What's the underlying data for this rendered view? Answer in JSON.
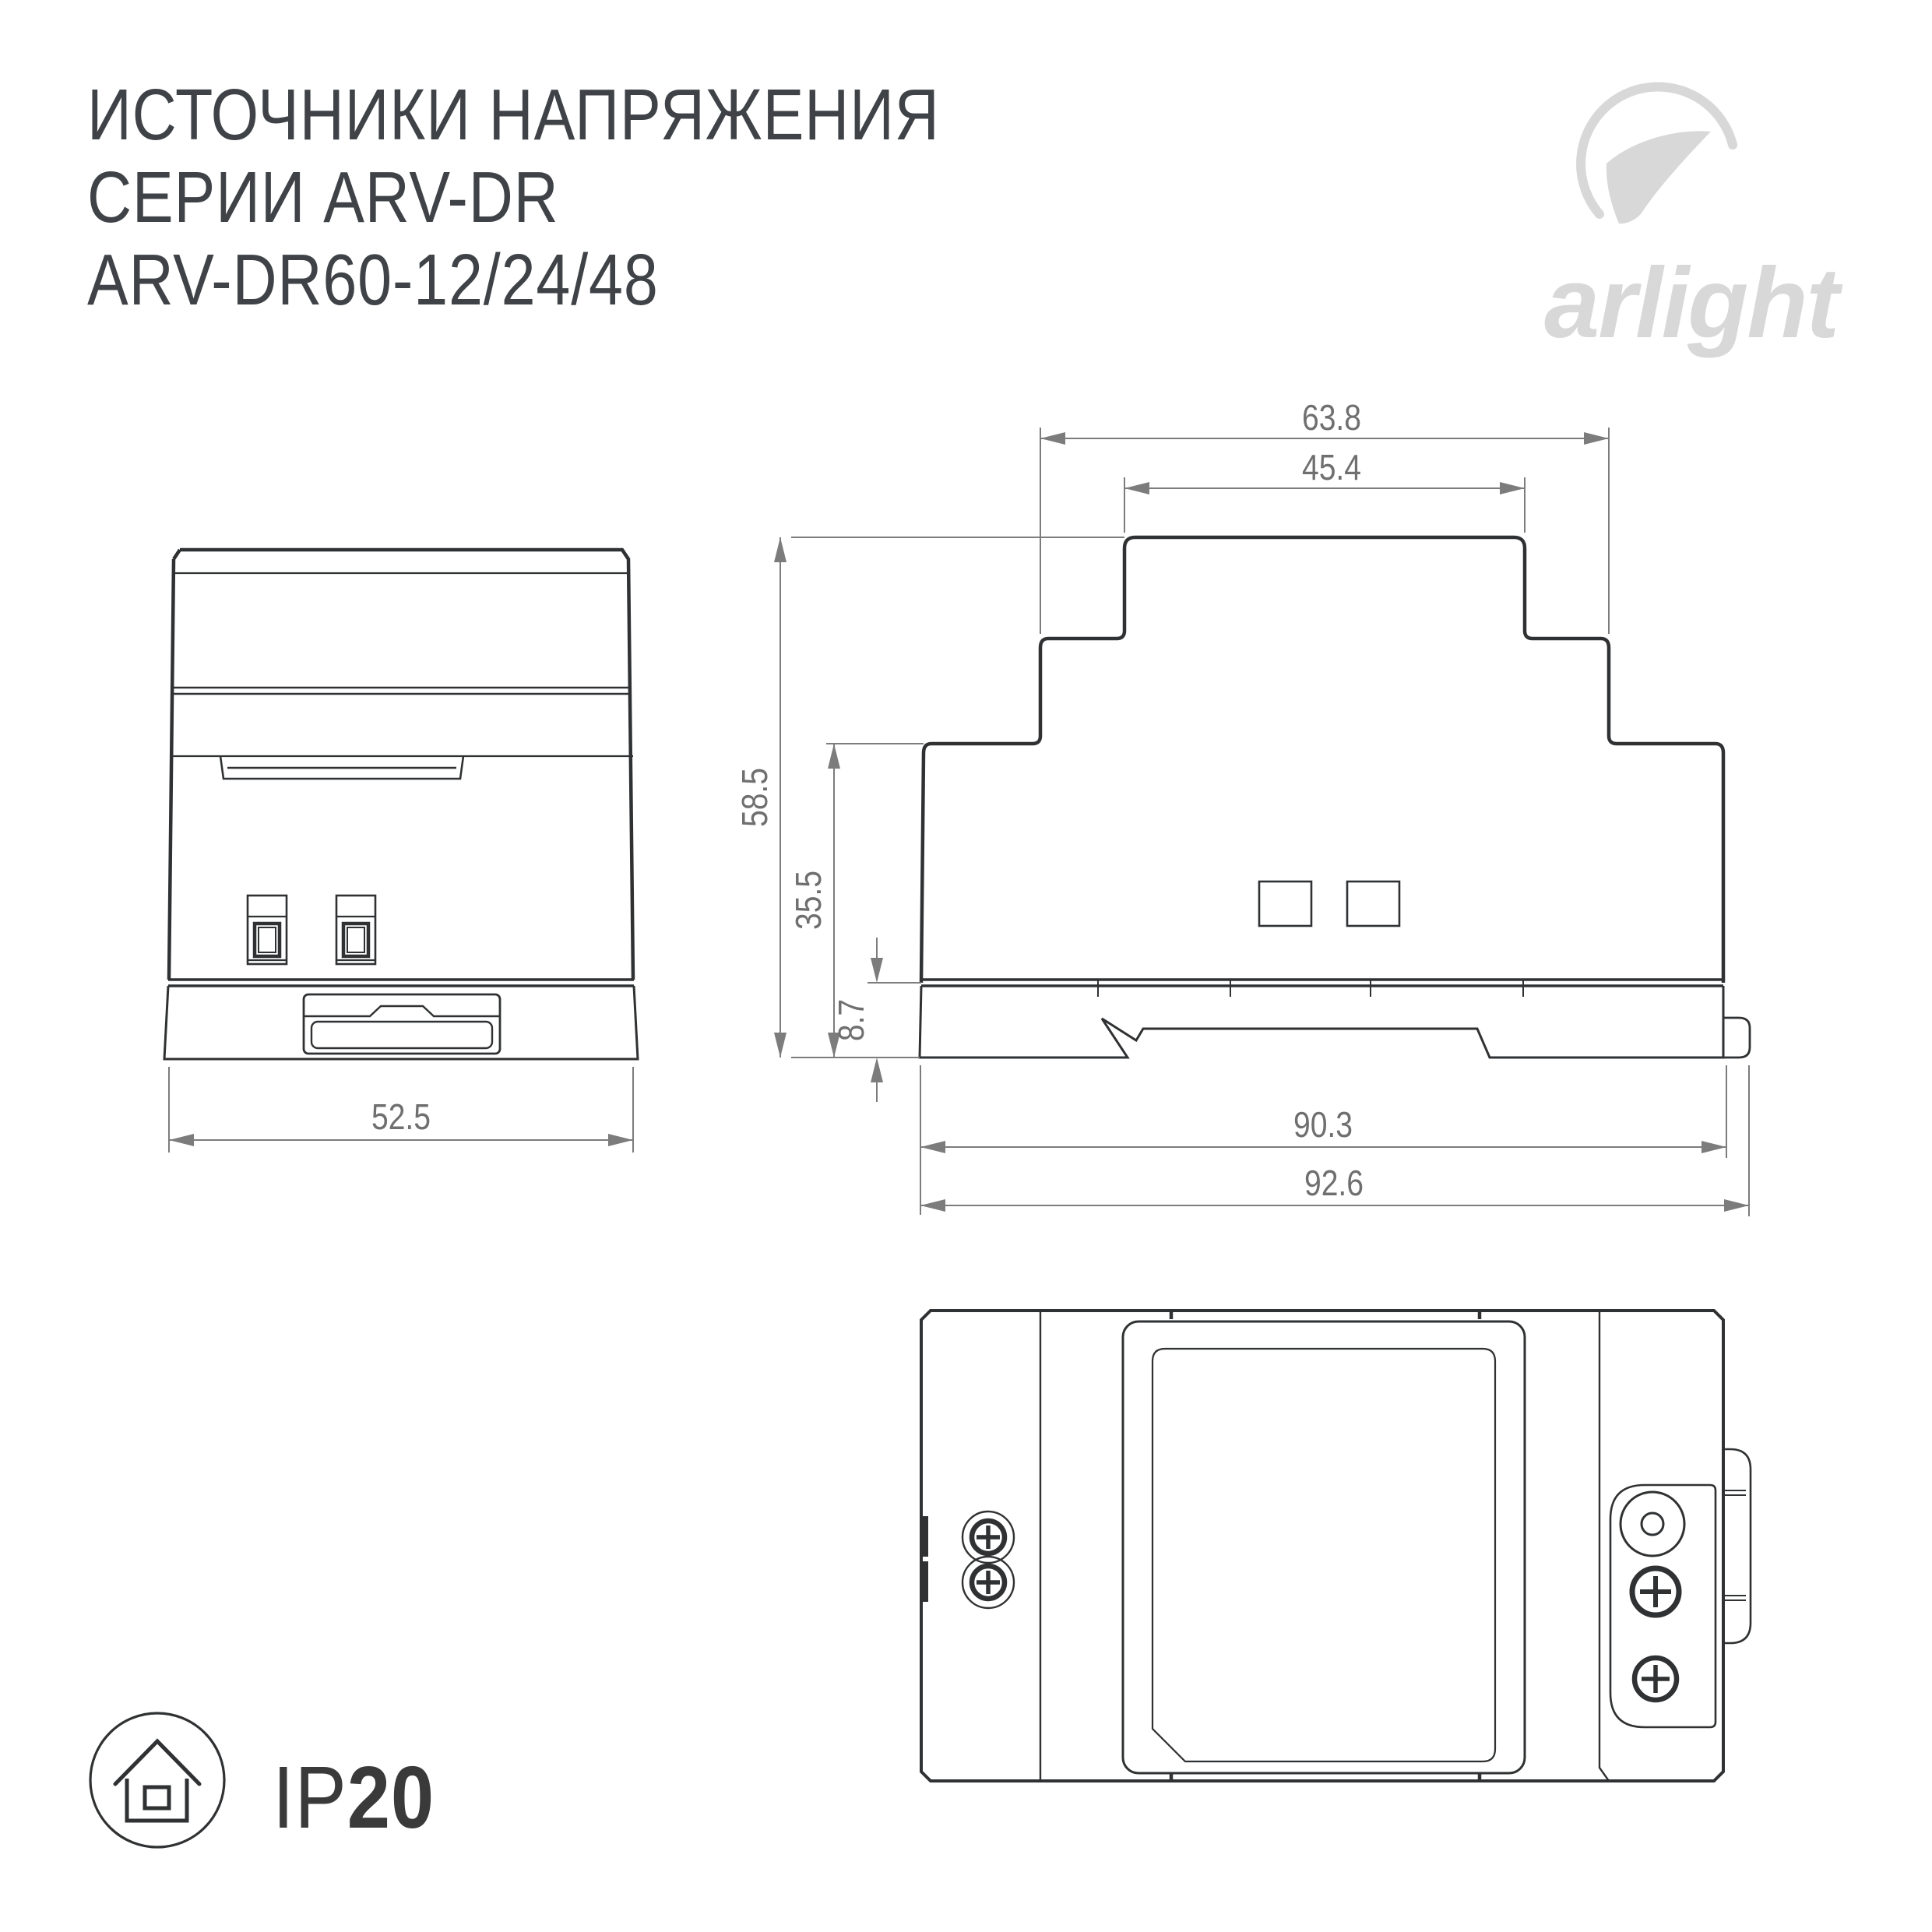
{
  "title": {
    "line1": "ИСТОЧНИКИ НАПРЯЖЕНИЯ",
    "line2": "СЕРИИ ARV-DR",
    "line3": "ARV-DR60-12/24/48"
  },
  "logo": {
    "brand": "arlight",
    "swoosh_icon": "arlight-swoosh-icon",
    "color": "#d8d8d8"
  },
  "dims": {
    "front_width": "52.5",
    "side_top_width": "63.8",
    "side_inner_width": "45.4",
    "height_total": "58.5",
    "height_mid": "35.5",
    "rail_height": "8.7",
    "body_length": "90.3",
    "total_length": "92.6"
  },
  "ip_rating": {
    "prefix": "IP",
    "value": "20",
    "icon": "ip20-house-icon"
  },
  "colors": {
    "line": "#2f3133",
    "dimension": "#7c7c7c",
    "dim_text": "#6f6f6f",
    "title_text": "#3f4347",
    "logo_gray": "#d8d8d8",
    "ip_text": "#3a3a3a",
    "background": "#ffffff"
  }
}
